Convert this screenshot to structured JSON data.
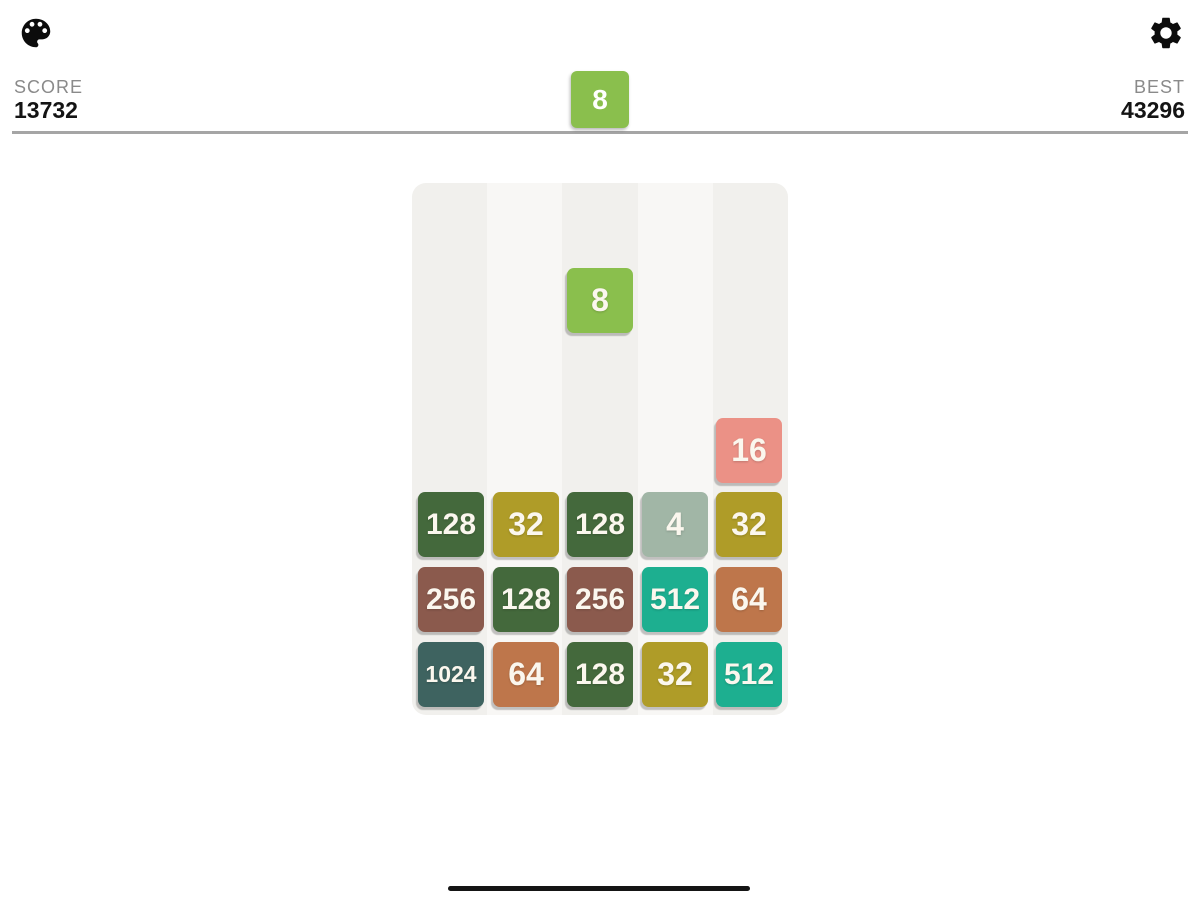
{
  "header": {
    "score_label": "SCORE",
    "score_value": "13732",
    "best_label": "BEST",
    "best_value": "43296"
  },
  "next_tile": {
    "value": "8"
  },
  "board": {
    "columns": 5,
    "column_shades": [
      "#F1F0ED",
      "#F8F7F5"
    ],
    "falling_tile": {
      "value": "8",
      "col": 3
    },
    "stack_tiles": [
      {
        "value": "16",
        "col": 5,
        "row": 1
      },
      {
        "value": "128",
        "col": 1,
        "row": 2
      },
      {
        "value": "32",
        "col": 2,
        "row": 2
      },
      {
        "value": "128",
        "col": 3,
        "row": 2
      },
      {
        "value": "4",
        "col": 4,
        "row": 2
      },
      {
        "value": "32",
        "col": 5,
        "row": 2
      },
      {
        "value": "256",
        "col": 1,
        "row": 3
      },
      {
        "value": "128",
        "col": 2,
        "row": 3
      },
      {
        "value": "256",
        "col": 3,
        "row": 3
      },
      {
        "value": "512",
        "col": 4,
        "row": 3
      },
      {
        "value": "64",
        "col": 5,
        "row": 3
      },
      {
        "value": "1024",
        "col": 1,
        "row": 4
      },
      {
        "value": "64",
        "col": 2,
        "row": 4
      },
      {
        "value": "128",
        "col": 3,
        "row": 4
      },
      {
        "value": "32",
        "col": 4,
        "row": 4
      },
      {
        "value": "512",
        "col": 5,
        "row": 4
      }
    ]
  },
  "tile_colors": {
    "4": "#A1B6A6",
    "8": "#8ABF4D",
    "16": "#EB9186",
    "32": "#AF9C28",
    "64": "#BE764B",
    "128": "#44693C",
    "256": "#8B5A4D",
    "512": "#1DAF90",
    "1024": "#3E6360"
  },
  "tile_text_color": "#FBF7EE",
  "icons": {
    "palette": "palette-icon",
    "settings": "gear-icon"
  }
}
